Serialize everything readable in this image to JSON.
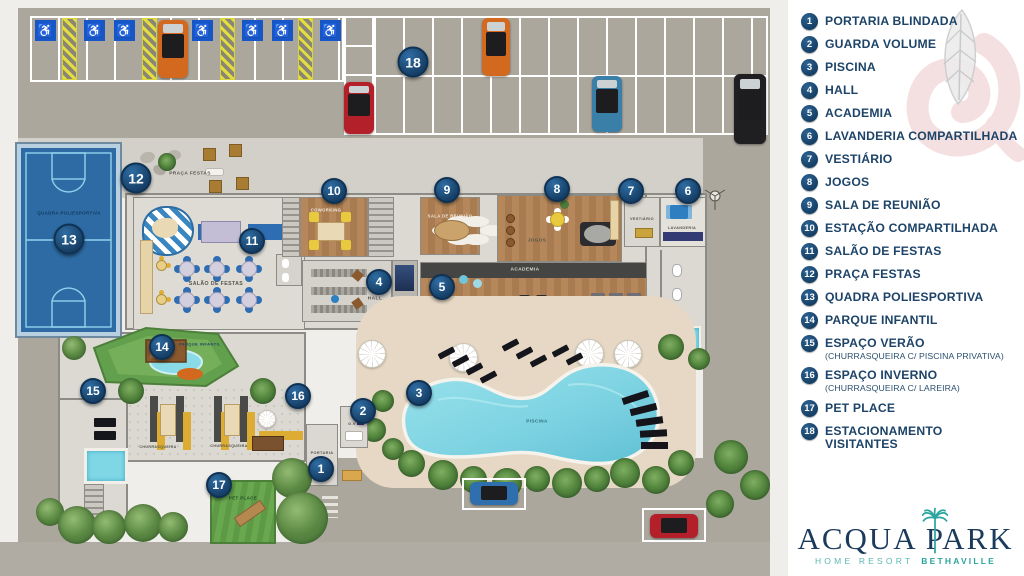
{
  "colors": {
    "marker_navy": "#163f66",
    "legend_navy": "#1d4468",
    "logo_navy": "#1b3a5c",
    "logo_teal": "#2aa49e",
    "pool_cyan": "#8adbe8",
    "court_blue": "#2e6ba4",
    "asphalt_gray": "#aba79d",
    "sand_deck": "#e6d8c4",
    "watermark_red": "#eec7ca"
  },
  "plan": {
    "markers": {
      "m1": "1",
      "m2": "2",
      "m3": "3",
      "m4": "4",
      "m5": "5",
      "m6": "6",
      "m7": "7",
      "m8": "8",
      "m9": "9",
      "m10": "10",
      "m11": "11",
      "m12": "12",
      "m13": "13",
      "m14": "14",
      "m15": "15",
      "m16": "16",
      "m17": "17",
      "m18": "18"
    },
    "labels": {
      "quadra": "QUADRA POLIESPORTIVA",
      "praca": "PRAÇA FESTAS",
      "salao": "SALÃO DE FESTAS",
      "coworking": "COWORKING",
      "reuniao": "SALA DE REUNIÃO",
      "jogos": "JOGOS",
      "vestiario": "VESTIÁRIO",
      "lavanderia": "LAVANDERIA",
      "hall": "HALL",
      "academia": "ACADEMIA",
      "piscina": "PISCINA",
      "gv": "G.V",
      "portaria": "PORTARIA",
      "churrasqueira_a": "CHURRASQUEIRA",
      "churrasqueira_b": "CHURRASQUEIRA",
      "parque": "PARQUE INFANTIL",
      "pet": "PET PLACE",
      "accessible_symbol": "♿"
    }
  },
  "legend": {
    "items": [
      {
        "num": "1",
        "label": "PORTARIA BLINDADA"
      },
      {
        "num": "2",
        "label": "GUARDA VOLUME"
      },
      {
        "num": "3",
        "label": "PISCINA"
      },
      {
        "num": "4",
        "label": "HALL"
      },
      {
        "num": "5",
        "label": "ACADEMIA"
      },
      {
        "num": "6",
        "label": "LAVANDERIA COMPARTILHADA"
      },
      {
        "num": "7",
        "label": "VESTIÁRIO"
      },
      {
        "num": "8",
        "label": "JOGOS"
      },
      {
        "num": "9",
        "label": "SALA DE REUNIÃO"
      },
      {
        "num": "10",
        "label": "ESTAÇÃO COMPARTILHADA"
      },
      {
        "num": "11",
        "label": "SALÃO DE FESTAS"
      },
      {
        "num": "12",
        "label": "PRAÇA FESTAS"
      },
      {
        "num": "13",
        "label": "QUADRA POLIESPORTIVA"
      },
      {
        "num": "14",
        "label": "PARQUE INFANTIL"
      },
      {
        "num": "15",
        "label": "ESPAÇO VERÃO",
        "sublabel": "(CHURRASQUEIRA C/ PISCINA PRIVATIVA)"
      },
      {
        "num": "16",
        "label": "ESPAÇO INVERNO",
        "sublabel": "(CHURRASQUEIRA C/ LAREIRA)"
      },
      {
        "num": "17",
        "label": "PET PLACE"
      },
      {
        "num": "18",
        "label": "ESTACIONAMENTO VISITANTES"
      }
    ]
  },
  "logo": {
    "word1": "ACQUA",
    "word2": "PARK",
    "tagline_left": "HOME RESORT",
    "tagline_right": "BETHAVILLE"
  }
}
